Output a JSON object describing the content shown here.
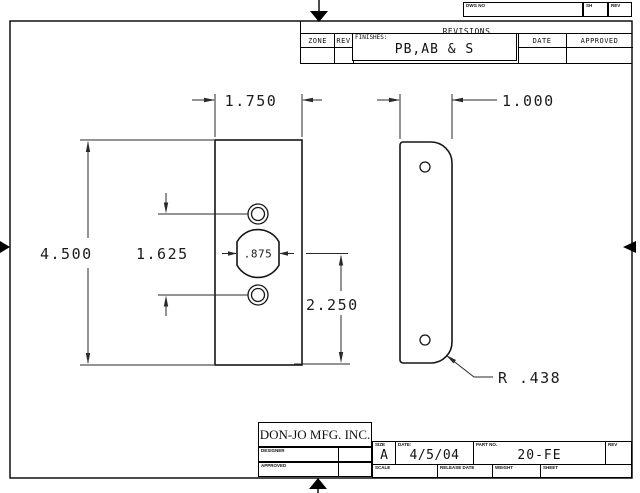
{
  "drawing": {
    "part_name": "20-FE filler plate",
    "dims": {
      "front_width": "1.750",
      "front_height": "4.500",
      "hole_spacing": "1.625",
      "center_hole": ".875",
      "bottom_offset": "2.250",
      "side_width": "1.000",
      "corner_radius": "R .438"
    }
  },
  "top_strip": {
    "dwg_no": "DWG NO",
    "sh": "SH",
    "rev": "REV"
  },
  "revisions": {
    "title": "REVISIONS",
    "zone": "ZONE",
    "rev": "REV",
    "date": "DATE",
    "approved": "APPROVED",
    "finishes_label": "FINISHES:",
    "finishes_value": "PB,AB & S"
  },
  "title_block": {
    "company": "DON-JO MFG. INC.",
    "designer_label": "DESIGNER",
    "approved_label": "APPROVED",
    "size_label": "SIZE",
    "size_value": "A",
    "date_label": "DATE:",
    "date_value": "4/5/04",
    "part_label": "PART NO.",
    "part_value": "20-FE",
    "rev_label": "REV",
    "scale_label": "SCALE",
    "release_label": "RELEASE DATE",
    "weight_label": "WEIGHT",
    "sheet_label": "SHEET"
  }
}
